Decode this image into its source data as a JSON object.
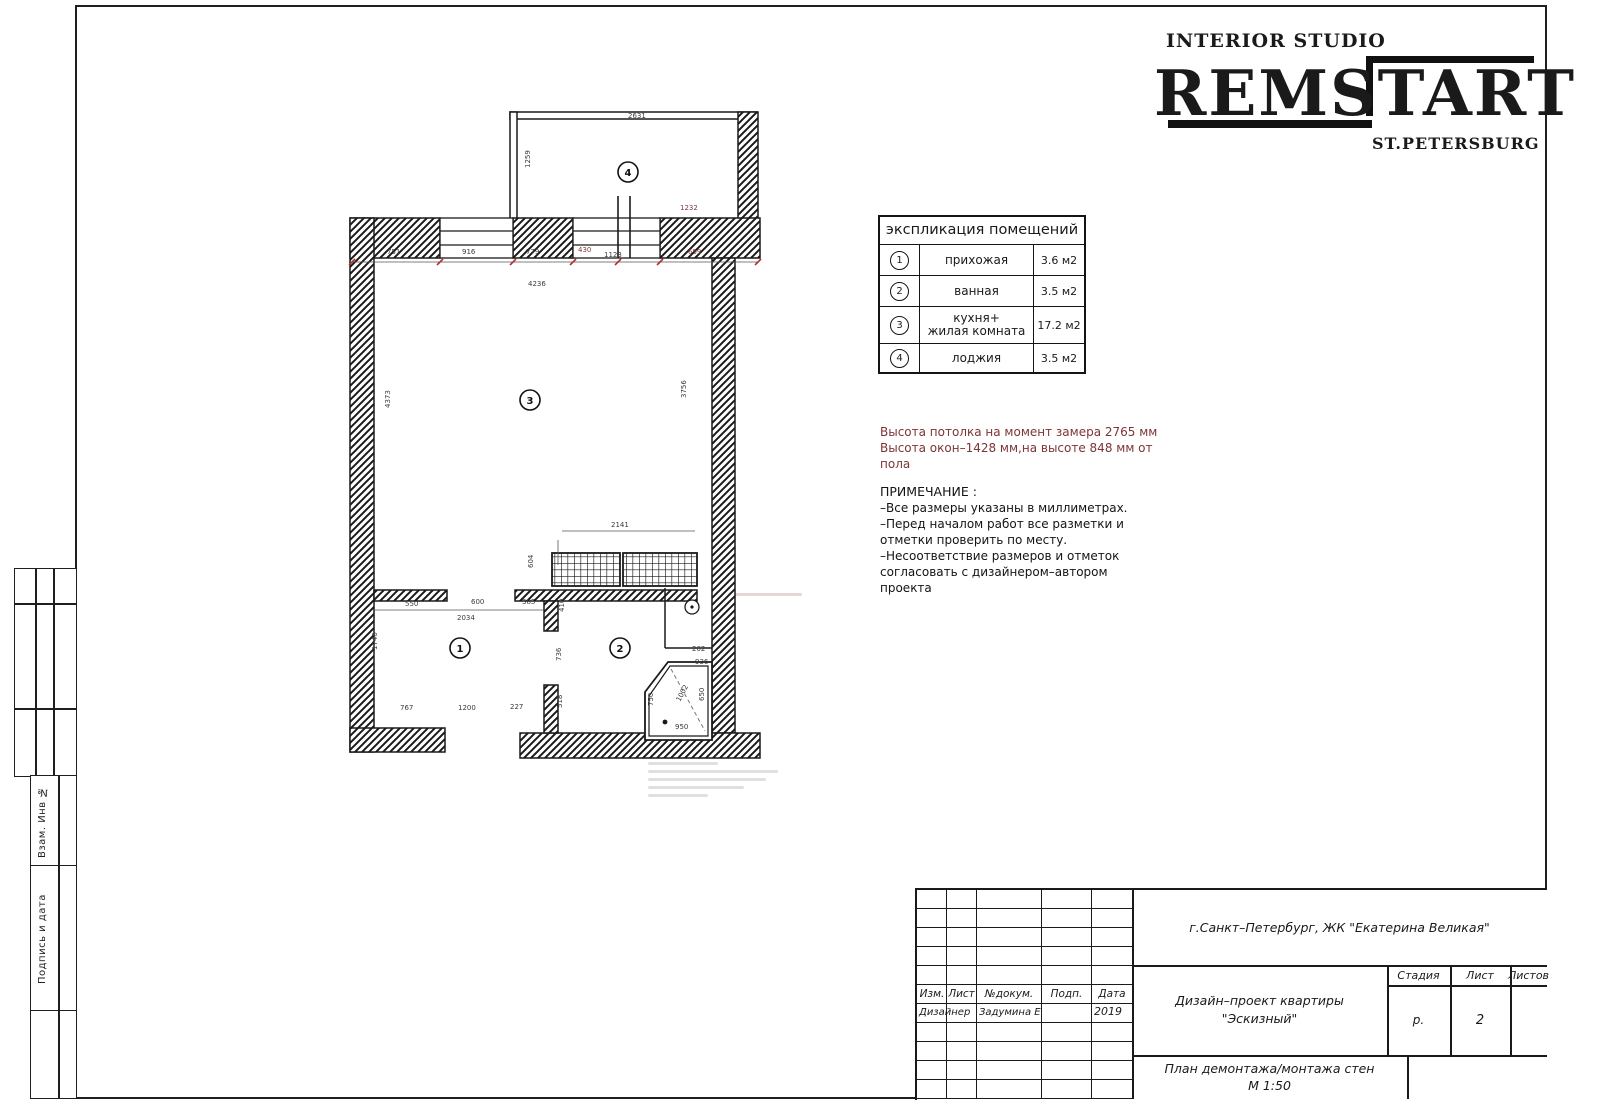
{
  "logo": {
    "tagline": "INTERIOR STUDIO",
    "name": "REMSTART",
    "city": "ST.PETERSBURG"
  },
  "explication": {
    "title": "экспликация помещений",
    "rows": [
      {
        "num": "1",
        "name": "прихожая",
        "name2": "",
        "area": "3.6 м2"
      },
      {
        "num": "2",
        "name": "ванная",
        "name2": "",
        "area": "3.5 м2"
      },
      {
        "num": "3",
        "name": "кухня+",
        "name2": "жилая комната",
        "area": "17.2 м2"
      },
      {
        "num": "4",
        "name": "лоджия",
        "name2": "",
        "area": "3.5 м2"
      }
    ]
  },
  "notes": {
    "height1": "Высота потолка на момент замера 2765 мм",
    "height2": "Высота окон–1428 мм,на высоте 848 мм от пола",
    "title": "ПРИМЕЧАНИЕ :",
    "item1": "–Все размеры указаны в миллиметрах.",
    "item2": "–Перед началом работ все разметки и отметки проверить по месту.",
    "item3": "–Несоответствие размеров и отметок согласовать с дизайнером–автором проекта"
  },
  "titleblock": {
    "location": "г.Санкт–Петербург, ЖК \"Екатерина Великая\"",
    "col_izm": "Изм.",
    "col_list": "Лист",
    "col_doc": "№докум.",
    "col_podp": "Подп.",
    "col_date": "Дата",
    "row_role": "Дизайнер",
    "row_name": "Задумина Е",
    "row_year": "2019",
    "project1": "Дизайн–проект квартиры",
    "project2": "\"Эскизный\"",
    "stage_h": "Стадия",
    "sheet_h": "Лист",
    "sheets_h": "Листов",
    "stage_v": "р.",
    "sheet_v": "2",
    "drawing1": "План демонтажа/монтажа стен",
    "drawing2": "М 1:50"
  },
  "frame": {
    "vlabel1": "Взам. Инв №",
    "vlabel2": "Подпись и дата"
  },
  "plan": {
    "rooms": [
      {
        "number": "1"
      },
      {
        "number": "2"
      },
      {
        "number": "3"
      },
      {
        "number": "4"
      }
    ],
    "dims": {
      "d751": "751",
      "d916": "916",
      "d779": "779",
      "d430": "430",
      "d1123": "1123",
      "d699": "699",
      "d4236": "4236",
      "d2631": "2631",
      "d1259": "1259",
      "d1232": "1232",
      "d4373": "4373",
      "d3756": "3756",
      "d2141": "2141",
      "d604": "604",
      "d550": "550",
      "d600": "600",
      "d385": "385",
      "d2034": "2034",
      "d1740": "1740",
      "d767": "767",
      "d1200": "1200",
      "d227": "227",
      "d410": "410",
      "d736": "736",
      "d518": "518",
      "d202": "202",
      "d936": "936",
      "d1002": "1002",
      "d650": "650",
      "d750": "750",
      "d950": "950"
    }
  }
}
